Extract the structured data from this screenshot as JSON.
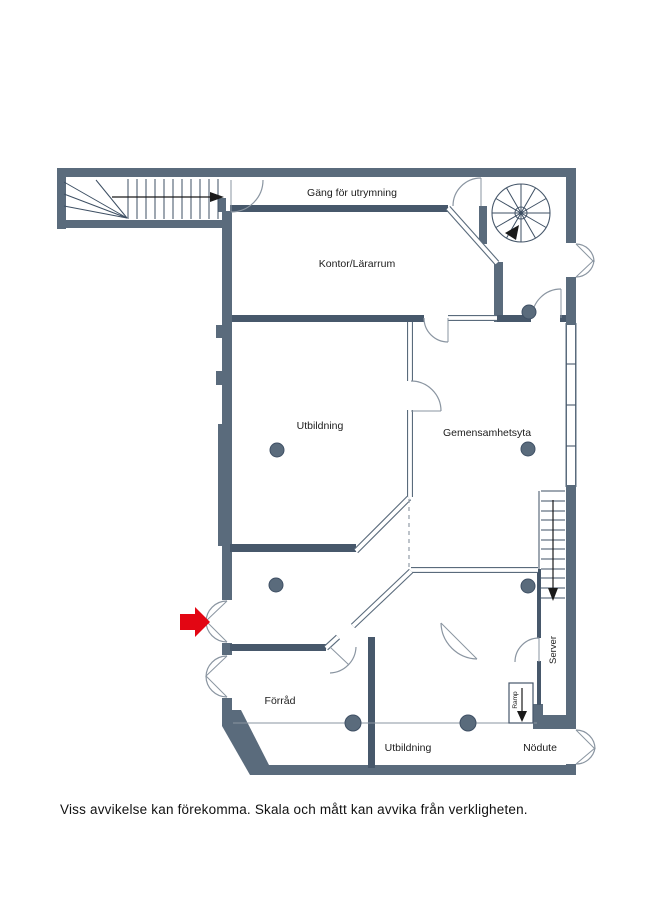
{
  "plan": {
    "background": "#ffffff",
    "wall_color": "#5a6b7c",
    "entrance_arrow_color": "#e30613",
    "labels": {
      "corridor": "Gäng för utrymning",
      "office": "Kontor/Lärarrum",
      "training_mid": "Utbildning",
      "common_area": "Gemensamhetsyta",
      "storage": "Förråd",
      "training_bottom": "Utbildning",
      "emergency_exit": "Nödute",
      "server": "Server",
      "ramp": "Ramp"
    },
    "disclaimer": "Viss avvikelse kan förekomma. Skala och mått kan avvika från verkligheten."
  }
}
